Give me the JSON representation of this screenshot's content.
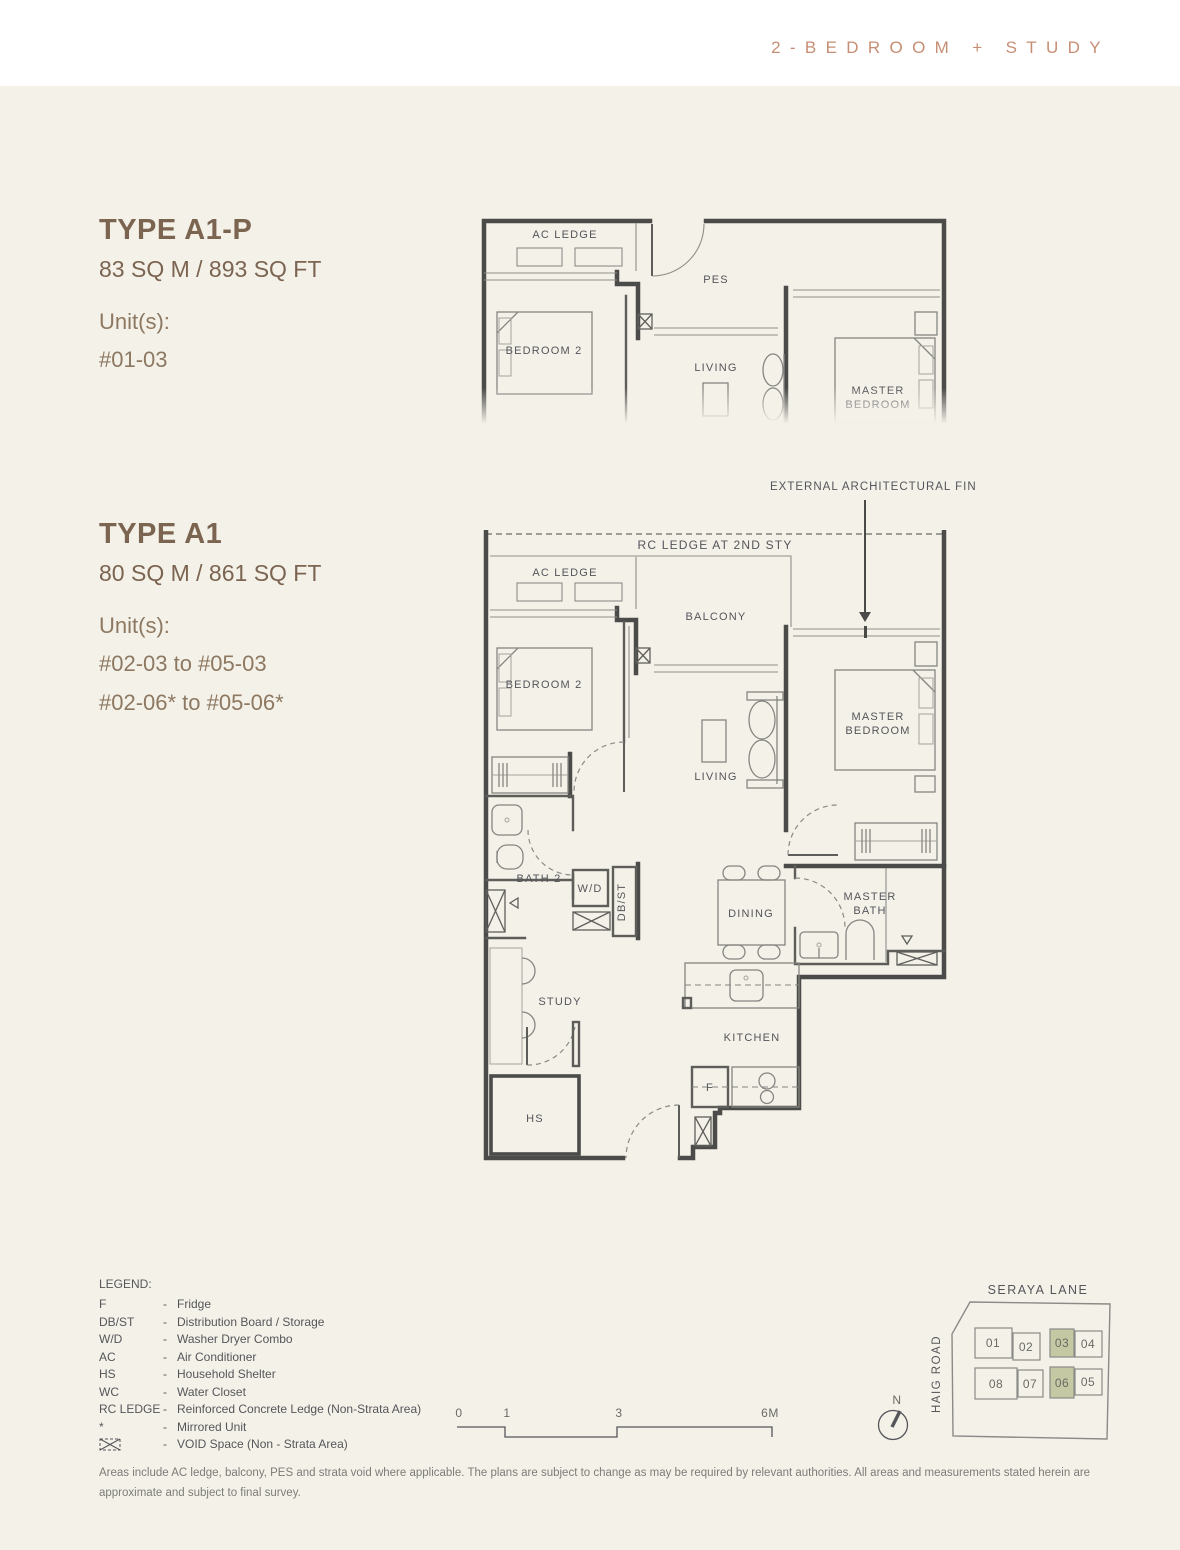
{
  "header": {
    "title": "2-BEDROOM + STUDY"
  },
  "unit_types": [
    {
      "name": "TYPE A1-P",
      "area": "83 SQ M / 893 SQ FT",
      "units_label": "Unit(s):",
      "units": [
        "#01-03"
      ]
    },
    {
      "name": "TYPE A1",
      "area": "80 SQ M / 861 SQ FT",
      "units_label": "Unit(s):",
      "units": [
        "#02-03 to #05-03",
        "#02-06* to #05-06*"
      ]
    }
  ],
  "plan_top": {
    "labels": {
      "ac_ledge": "AC LEDGE",
      "pes": "PES",
      "bedroom2": "BEDROOM 2",
      "living": "LIVING",
      "master_1": "MASTER",
      "master_2": "BEDROOM"
    }
  },
  "plan_main": {
    "annotation_fin": "EXTERNAL ARCHITECTURAL FIN",
    "annotation_rc": "RC LEDGE AT 2ND STY",
    "labels": {
      "ac_ledge": "AC LEDGE",
      "balcony": "BALCONY",
      "bedroom2": "BEDROOM 2",
      "living": "LIVING",
      "master_1": "MASTER",
      "master_2": "BEDROOM",
      "bath2": "BATH 2",
      "wd": "W/D",
      "dbst": "DB/ST",
      "dining": "DINING",
      "masterbath_1": "MASTER",
      "masterbath_2": "BATH",
      "study": "STUDY",
      "hs": "HS",
      "kitchen": "KITCHEN",
      "fridge": "F"
    }
  },
  "legend": {
    "title": "LEGEND:",
    "items": [
      {
        "key": "F",
        "desc": "Fridge"
      },
      {
        "key": "DB/ST",
        "desc": "Distribution Board / Storage"
      },
      {
        "key": "W/D",
        "desc": "Washer Dryer Combo"
      },
      {
        "key": "AC",
        "desc": "Air Conditioner"
      },
      {
        "key": "HS",
        "desc": "Household Shelter"
      },
      {
        "key": "WC",
        "desc": "Water Closet"
      },
      {
        "key": "RC LEDGE",
        "desc": "Reinforced Concrete Ledge (Non-Strata Area)"
      },
      {
        "key": "*",
        "desc": "Mirrored Unit"
      },
      {
        "key": "",
        "icon": "void-space-icon",
        "desc": "VOID Space (Non - Strata Area)"
      }
    ]
  },
  "scale_bar": {
    "ticks": [
      "0",
      "1",
      "3",
      "6M"
    ]
  },
  "compass": {
    "label": "N"
  },
  "site_plan": {
    "street_top": "SERAYA LANE",
    "street_left": "HAIG ROAD",
    "blocks": [
      "01",
      "02",
      "03",
      "04",
      "08",
      "07",
      "06",
      "05"
    ],
    "highlighted": [
      "03",
      "06"
    ],
    "highlight_color": "#c5c9a3"
  },
  "disclaimer": "Areas include AC ledge, balcony, PES and strata void where applicable. The plans are subject to change as may be required by relevant authorities. All areas and measurements stated herein are approximate and subject to final survey.",
  "colors": {
    "accent": "#c68e74",
    "heading": "#7b6450",
    "units_text": "#8d7861",
    "page_bg": "#f4f1e9",
    "wall_line": "#4b4b49",
    "highlight_green": "#c5c9a3"
  }
}
